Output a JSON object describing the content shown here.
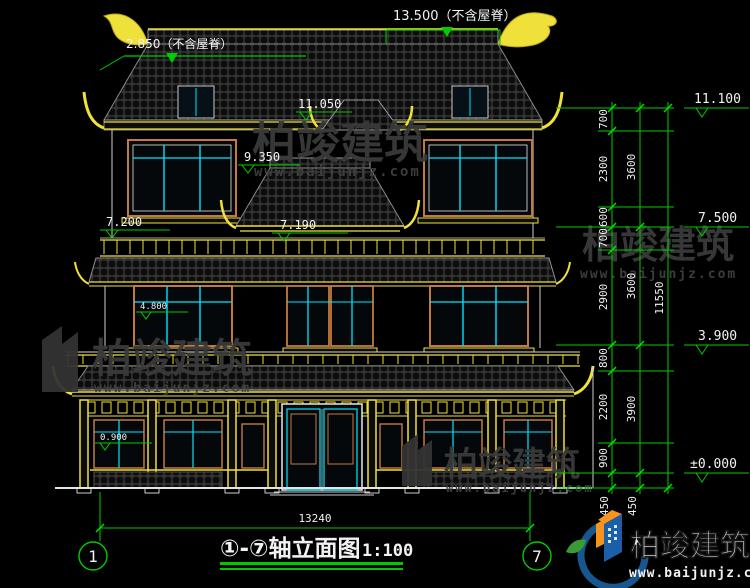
{
  "colors": {
    "background": "#000000",
    "dimension_green": "#00cc00",
    "cad_yellow": "#f0e13a",
    "cad_cyan": "#00e5ff",
    "frame_orange": "#c47a3d",
    "text_white": "#f2f2f2",
    "watermark_gray": "#3a3a3a",
    "logo_blue": "#1a5fa8",
    "logo_orange": "#f7941e"
  },
  "top_annotations": {
    "ridge_total": "13.500（不含屋脊）",
    "ridge_secondary": "2.850（不含屋脊）"
  },
  "elevations": {
    "right": [
      {
        "label": "11.100"
      },
      {
        "label": "7.500"
      },
      {
        "label": "3.900"
      },
      {
        "label": "±0.000"
      }
    ],
    "inner": [
      {
        "label": "11.050"
      },
      {
        "label": "9.350"
      },
      {
        "label": "7.200"
      },
      {
        "label": "7.190"
      },
      {
        "label": "4.800"
      },
      {
        "label": "0.900"
      }
    ]
  },
  "dims": {
    "col1": [
      "700",
      "2300",
      "600",
      "700",
      "2900",
      "800",
      "2200",
      "900"
    ],
    "col1_bottom": "450",
    "col2": [
      "3600",
      "3600",
      "3900"
    ],
    "col2_bottom": "450",
    "overall": "11550",
    "width": "13240"
  },
  "axes": {
    "left": "1",
    "right": "7"
  },
  "title": {
    "text": "①-⑦轴立面图",
    "scale": "1:100"
  },
  "brand": {
    "name": "柏竣建筑",
    "url": "www.baijunjz.com"
  }
}
